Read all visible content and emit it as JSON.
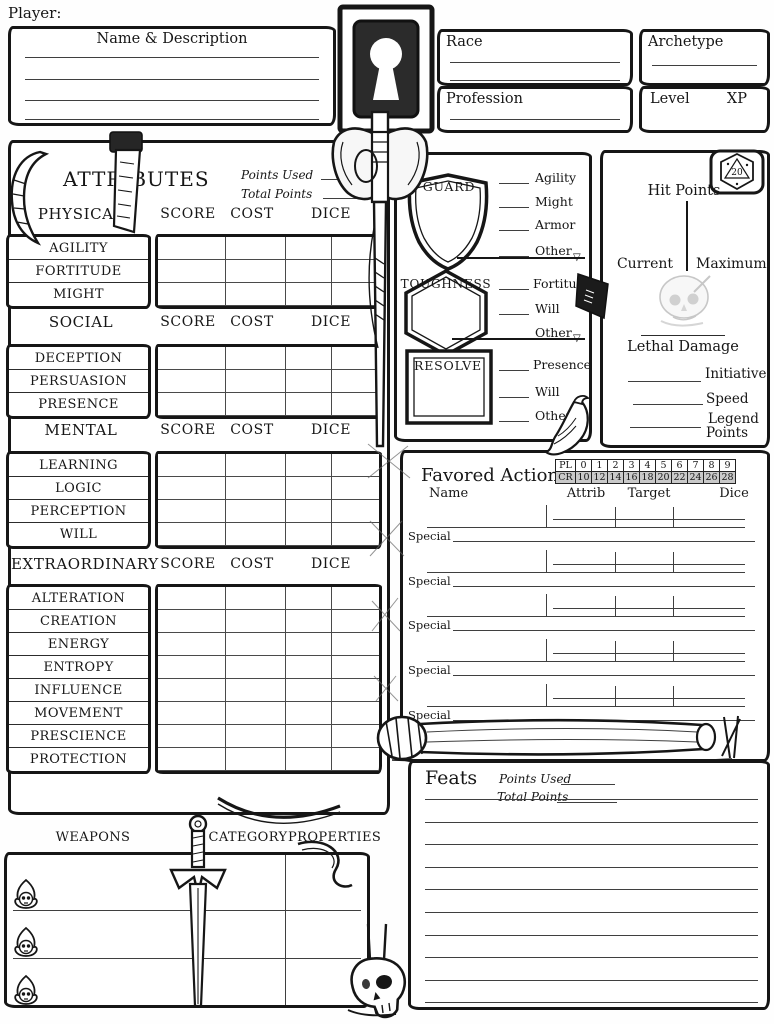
{
  "colors": {
    "ink": "#161616",
    "line": "#3f3f3f",
    "cr_row_bg": "#c9c9c9",
    "ghost_gray": "#9a9a9a"
  },
  "header": {
    "player_label": "Player:",
    "name_box_title": "Name & Description",
    "race_label": "Race",
    "profession_label": "Profession",
    "archetype_label": "Archetype",
    "level_label": "Level",
    "xp_label": "XP"
  },
  "attributes": {
    "title": "ATTRIBUTES",
    "points_used_label": "Points Used",
    "total_points_label": "Total Points",
    "col_score": "SCORE",
    "col_cost": "COST",
    "col_dice": "DICE",
    "groups": [
      {
        "name": "PHYSICAL",
        "attrs": [
          "AGILITY",
          "FORTITUDE",
          "MIGHT"
        ]
      },
      {
        "name": "SOCIAL",
        "attrs": [
          "DECEPTION",
          "PERSUASION",
          "PRESENCE"
        ]
      },
      {
        "name": "MENTAL",
        "attrs": [
          "LEARNING",
          "LOGIC",
          "PERCEPTION",
          "WILL"
        ]
      },
      {
        "name": "EXTRAORDINARY",
        "attrs": [
          "ALTERATION",
          "CREATION",
          "ENERGY",
          "ENTROPY",
          "INFLUENCE",
          "MOVEMENT",
          "PRESCIENCE",
          "PROTECTION"
        ]
      }
    ]
  },
  "defenses": {
    "guard": {
      "name": "GUARD",
      "mods": [
        "Agility",
        "Might",
        "Armor",
        "Other"
      ]
    },
    "toughness": {
      "name": "TOUGHNESS",
      "mods": [
        "Fortitude",
        "Will",
        "Other"
      ]
    },
    "resolve": {
      "name": "RESOLVE",
      "mods": [
        "Presence",
        "Will",
        "Other"
      ]
    }
  },
  "vitals": {
    "hit_points_label": "Hit Points",
    "current_label": "Current",
    "maximum_label": "Maximum",
    "lethal_damage_label": "Lethal Damage",
    "initiative_label": "Initiative",
    "speed_label": "Speed",
    "legend_label": "Legend",
    "points_label": "Points",
    "d20_label": "20"
  },
  "favored_actions": {
    "title": "Favored Actions",
    "pl": [
      "PL",
      "0",
      "1",
      "2",
      "3",
      "4",
      "5",
      "6",
      "7",
      "8",
      "9"
    ],
    "cr": [
      "CR",
      "10",
      "12",
      "14",
      "16",
      "18",
      "20",
      "22",
      "24",
      "26",
      "28"
    ],
    "col_name": "Name",
    "col_attrib": "Attrib",
    "col_target": "Target",
    "col_dice": "Dice",
    "special_label": "Special"
  },
  "feats": {
    "title": "Feats",
    "points_used_label": "Points Used",
    "total_points_label": "Total Points"
  },
  "weapons": {
    "weapons_label": "WEAPONS",
    "category_label": "CATEGORY",
    "properties_label": "PROPERTIES"
  },
  "icons": {
    "flag_triangle": "▽"
  }
}
